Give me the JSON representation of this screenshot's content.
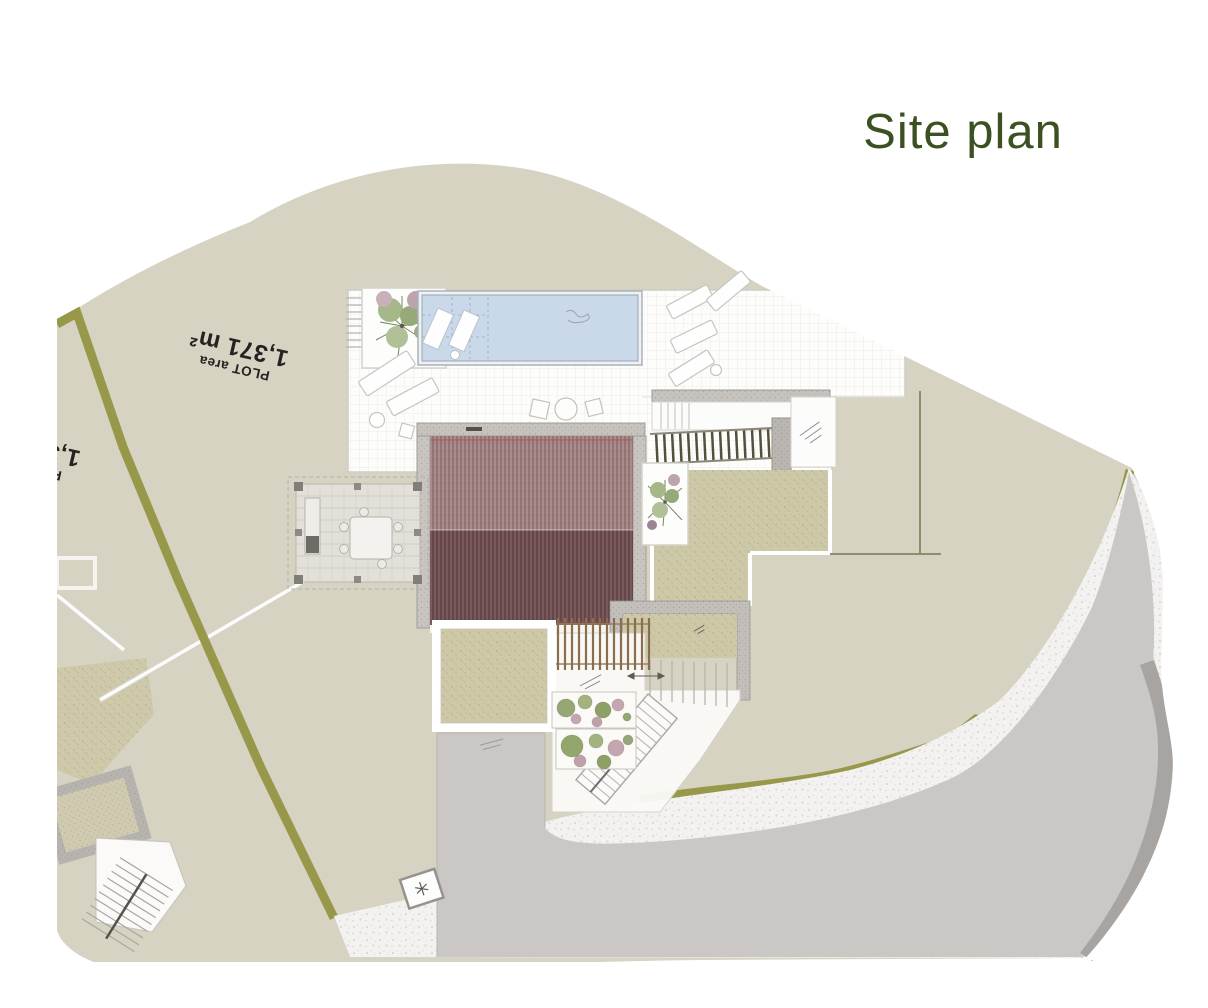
{
  "page": {
    "title": "Site plan"
  },
  "plan": {
    "plot_label": {
      "small": "PLOT area",
      "large": "1,371 m²"
    },
    "neighbor_plot_label": {
      "small": "PLOT area",
      "large": "1,371 m²"
    }
  },
  "colors": {
    "title_green": "#3c5122",
    "label_ink": "#232321",
    "land": "#d6d3c2",
    "ground_texture": "#cdc8a8",
    "boundary_olive": "#98984a",
    "road_gray": "#cac7c5",
    "curb_gray": "#a7a4a1",
    "gravel_white": "#f3f2f0",
    "pool_water": "#c9d9e9",
    "roof_upper": "#a38384",
    "roof_lower": "#6f4e4f",
    "wall_gray": "#c6c3bf",
    "terrace_white": "#fdfdfc",
    "wood_brown": "#8a6e50"
  }
}
